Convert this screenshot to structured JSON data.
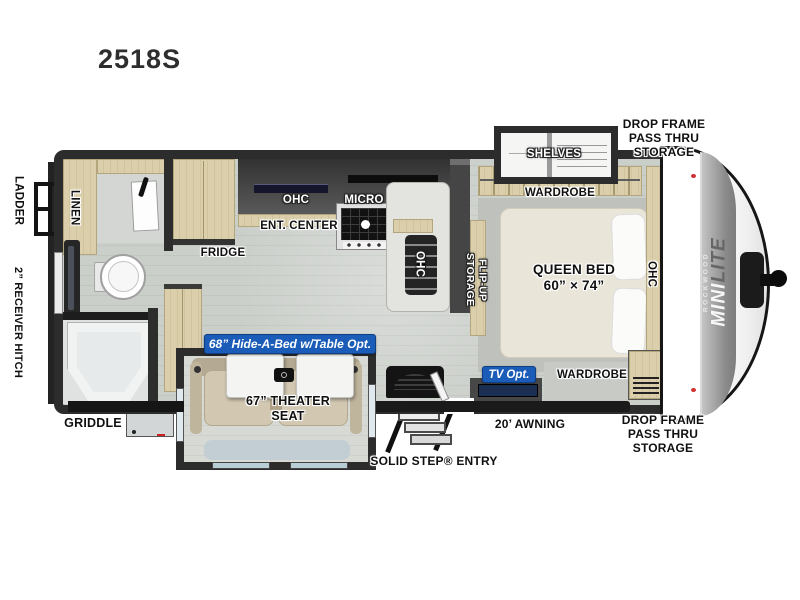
{
  "title": "2518S",
  "colors": {
    "badge_blue": "#1a5cb8",
    "wall_dark": "#2d2d2d",
    "cabinet_tan": "#d9cca8",
    "floor_gray": "#cacec9",
    "clearance_light_red": "#d03030"
  },
  "labels": {
    "ladder": "LADDER",
    "receiver_hitch": "2” RECEIVER HITCH",
    "linen": "LINEN",
    "fridge": "FRIDGE",
    "ohc": "OHC",
    "ent_center": "ENT. CENTER",
    "micro": "MICRO",
    "shelves": "SHELVES",
    "wardrobe": "WARDROBE",
    "flip_up_storage": "FLIP-UP\nSTORAGE",
    "queen_bed": "QUEEN BED\n60” × 74”",
    "theater_seat": "67” THEATER\nSEAT",
    "griddle": "GRIDDLE",
    "solid_step_entry": "SOLID STEP® ENTRY",
    "awning": "20’ AWNING",
    "drop_frame_storage": "DROP FRAME\nPASS THRU\nSTORAGE"
  },
  "badges": {
    "hide_a_bed": "68” Hide-A-Bed w/Table Opt.",
    "tv_option": "TV Opt."
  },
  "brand": {
    "maker": "ROCKWOOD",
    "model_word1": "MINI",
    "model_word2": "LITE"
  }
}
